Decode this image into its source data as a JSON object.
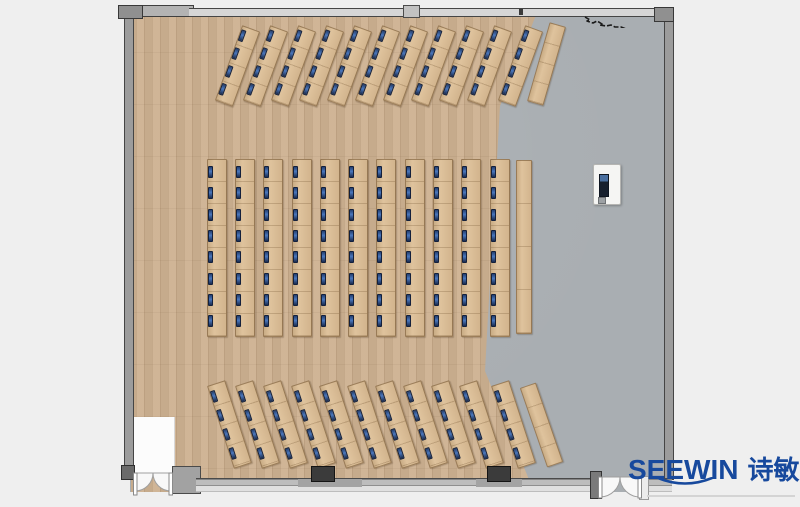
{
  "page": {
    "background": "#efefef"
  },
  "logo": {
    "brand": "SEEWIN",
    "brand_cn": "诗敏",
    "color": "#17499d"
  },
  "palette": {
    "wood_floor": "#cdb191",
    "gray_floor": "#a9aeb2",
    "desk_wood": "#d8bc96",
    "seat_blue": "#3f6cb2",
    "wall_gray": "#9c9c9c",
    "wall_dark": "#454545"
  },
  "floorplan": {
    "room": {
      "x": 118,
      "y": 5,
      "width": 554,
      "height": 497
    },
    "entry_alcove": {
      "x": 132,
      "y": 417,
      "width": 42,
      "height": 57
    },
    "podium": {
      "x": 593,
      "y": 164,
      "width": 26,
      "height": 39
    },
    "doors": [
      {
        "location": "bottom-left",
        "type": "double-swing"
      },
      {
        "location": "bottom-right",
        "type": "double-swing"
      }
    ],
    "sections": [
      {
        "name": "front-angled-desk-rows",
        "angle_deg": 20,
        "desk_length": 78,
        "desk_width": 17,
        "y_top": 28,
        "x_tops": [
          250,
          278,
          306,
          334,
          362,
          390,
          418,
          446,
          474,
          502,
          533
        ],
        "seats_per_desk": 4,
        "seat_first": 3,
        "seat_step": 19,
        "joint_step": 19.5,
        "side_table": {
          "x_top": 557,
          "y_top": 25,
          "angle_deg": 16,
          "length": 80,
          "width": 15,
          "joint_step": 20
        }
      },
      {
        "name": "center-desk-columns",
        "angle_deg": 0,
        "desk_length": 176,
        "desk_width": 18,
        "y_top": 159,
        "x_tops": [
          216,
          244,
          272,
          301,
          329,
          357,
          385,
          414,
          442,
          470,
          499
        ],
        "seats_per_desk": 8,
        "seat_first": 6,
        "seat_step": 21.3,
        "joint_step": 22,
        "side_table": {
          "x_top": 523,
          "y_top": 160,
          "angle_deg": 0,
          "length": 172,
          "width": 14,
          "joint_step": 43
        }
      },
      {
        "name": "back-angled-desk-rows",
        "angle_deg": -18,
        "desk_length": 85,
        "desk_width": 17,
        "y_top": 383,
        "x_tops": [
          215,
          243,
          271,
          299,
          327,
          355,
          383,
          411,
          439,
          467,
          499
        ],
        "seats_per_desk": 4,
        "seat_first": 5,
        "seat_step": 20,
        "joint_step": 21,
        "side_table": {
          "x_top": 527,
          "y_top": 385,
          "angle_deg": -19,
          "length": 82,
          "width": 15,
          "joint_step": 21
        }
      }
    ]
  }
}
